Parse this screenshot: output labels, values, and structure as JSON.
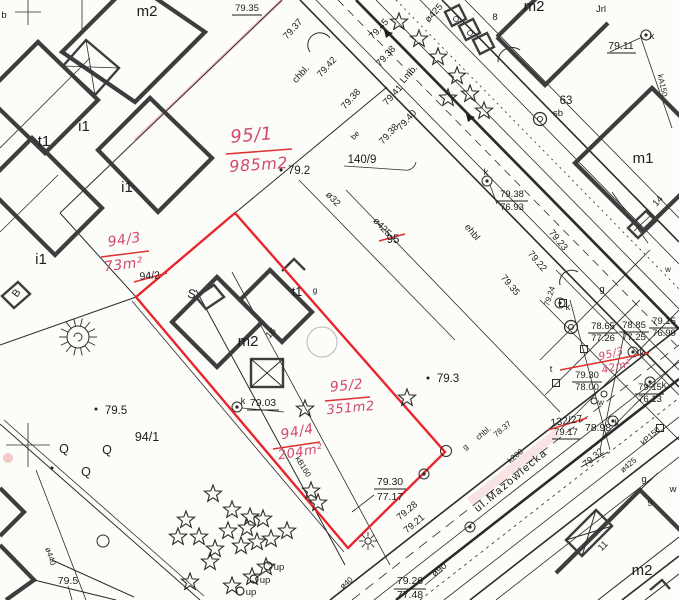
{
  "colors": {
    "paper": "#fcfcf9",
    "line": "#2b2b2b",
    "building": "#3d3d3d",
    "red_boundary": "#e8262d",
    "hand_red": "#d14a72"
  },
  "map": {
    "red_parcel": {
      "points": "235,213 445,452 348,548 136,297"
    },
    "labels": [
      {
        "t": "m2",
        "x": 147,
        "y": 16,
        "r": 0,
        "c": "b14"
      },
      {
        "t": "79.35",
        "x": 247,
        "y": 11,
        "r": 0,
        "c": "b9"
      },
      {
        "t": "b",
        "x": 4,
        "y": 18,
        "r": 0,
        "c": "b9"
      },
      {
        "t": "t1",
        "x": 44,
        "y": 146,
        "r": 0,
        "c": "b14"
      },
      {
        "t": "i1",
        "x": 84,
        "y": 131,
        "r": 0,
        "c": "b14"
      },
      {
        "t": "i1",
        "x": 127,
        "y": 192,
        "r": 0,
        "c": "b14"
      },
      {
        "t": "i1",
        "x": 41,
        "y": 264,
        "r": 0,
        "c": "b14"
      },
      {
        "t": "B",
        "x": 19,
        "y": 295,
        "r": -55,
        "c": "b10"
      },
      {
        "t": "m2",
        "x": 534,
        "y": 11,
        "r": 0,
        "c": "b14"
      },
      {
        "t": "Jrl",
        "x": 601,
        "y": 12,
        "r": 0,
        "c": "b9"
      },
      {
        "t": "79.11",
        "x": 621,
        "y": 49,
        "r": 0,
        "c": "b10"
      },
      {
        "t": "k",
        "x": 652,
        "y": 39,
        "r": 0,
        "c": "b9"
      },
      {
        "t": "kA150",
        "x": 660,
        "y": 86,
        "r": 78,
        "c": "b8"
      },
      {
        "t": "63",
        "x": 566,
        "y": 104,
        "r": 0,
        "c": "b11"
      },
      {
        "t": "sb",
        "x": 558,
        "y": 116,
        "r": 0,
        "c": "b9"
      },
      {
        "t": "m1",
        "x": 643,
        "y": 163,
        "r": 0,
        "c": "b14"
      },
      {
        "t": "14",
        "x": 660,
        "y": 203,
        "r": -48,
        "c": "b9"
      },
      {
        "t": "8",
        "x": 495,
        "y": 20,
        "r": 0,
        "c": "b9"
      },
      {
        "t": "79.2",
        "x": 299,
        "y": 174,
        "r": 0,
        "c": "b11"
      },
      {
        "t": "140/9",
        "x": 362,
        "y": 163,
        "r": 0,
        "c": "b11"
      },
      {
        "t": "95",
        "x": 393,
        "y": 243,
        "r": 0,
        "c": "b11"
      },
      {
        "t": "94/2",
        "x": 150,
        "y": 279,
        "r": -4,
        "c": "b10"
      },
      {
        "t": "94/1",
        "x": 147,
        "y": 441,
        "r": 0,
        "c": "b12"
      },
      {
        "t": "79.5",
        "x": 116,
        "y": 414,
        "r": 0,
        "c": "b11"
      },
      {
        "t": "79.5",
        "x": 68,
        "y": 584,
        "r": 0,
        "c": "b10"
      },
      {
        "t": "79.3",
        "x": 448,
        "y": 382,
        "r": 0,
        "c": "b11"
      },
      {
        "t": "79.38",
        "x": 512,
        "y": 197,
        "r": 0,
        "c": "b9"
      },
      {
        "t": "76.93",
        "x": 512,
        "y": 210,
        "r": 0,
        "c": "b9"
      },
      {
        "t": "k",
        "x": 486,
        "y": 175,
        "r": 0,
        "c": "b9"
      },
      {
        "t": "79.37",
        "x": 295,
        "y": 31,
        "r": -48,
        "c": "b9"
      },
      {
        "t": "chbl.",
        "x": 303,
        "y": 76,
        "r": -48,
        "c": "b9"
      },
      {
        "t": "79.42",
        "x": 329,
        "y": 69,
        "r": -48,
        "c": "b9"
      },
      {
        "t": "79.38",
        "x": 353,
        "y": 101,
        "r": -48,
        "c": "b9"
      },
      {
        "t": "be",
        "x": 357,
        "y": 137,
        "r": -48,
        "c": "b8"
      },
      {
        "t": "79.45",
        "x": 381,
        "y": 31,
        "r": -48,
        "c": "b9"
      },
      {
        "t": "79.38",
        "x": 388,
        "y": 58,
        "r": -48,
        "c": "b9"
      },
      {
        "t": "Lmb.",
        "x": 411,
        "y": 76,
        "r": -48,
        "c": "b9"
      },
      {
        "t": "79.41",
        "x": 395,
        "y": 97,
        "r": -48,
        "c": "b9"
      },
      {
        "t": "79.40",
        "x": 409,
        "y": 122,
        "r": -48,
        "c": "b9"
      },
      {
        "t": "79.38",
        "x": 391,
        "y": 136,
        "r": -48,
        "c": "b9"
      },
      {
        "t": "ø425",
        "x": 436,
        "y": 15,
        "r": -48,
        "c": "b9"
      },
      {
        "t": "ø32",
        "x": 331,
        "y": 201,
        "r": 46,
        "c": "b9"
      },
      {
        "t": "ø425",
        "x": 380,
        "y": 229,
        "r": 46,
        "c": "b9"
      },
      {
        "t": "ehbl",
        "x": 470,
        "y": 234,
        "r": 50,
        "c": "b9"
      },
      {
        "t": "79.23",
        "x": 556,
        "y": 242,
        "r": 50,
        "c": "b9"
      },
      {
        "t": "79.22",
        "x": 535,
        "y": 263,
        "r": 50,
        "c": "b9"
      },
      {
        "t": "79.35",
        "x": 508,
        "y": 287,
        "r": 50,
        "c": "b9"
      },
      {
        "t": "g",
        "x": 602,
        "y": 292,
        "r": 0,
        "c": "b9"
      },
      {
        "t": "79.24",
        "x": 552,
        "y": 297,
        "r": -72,
        "c": "b8"
      },
      {
        "t": "78.65",
        "x": 603,
        "y": 329,
        "r": 0,
        "c": "b9"
      },
      {
        "t": "77.26",
        "x": 603,
        "y": 341,
        "r": 0,
        "c": "b9"
      },
      {
        "t": "78.85",
        "x": 634,
        "y": 328,
        "r": 0,
        "c": "b9"
      },
      {
        "t": "77.25",
        "x": 634,
        "y": 340,
        "r": 0,
        "c": "b9"
      },
      {
        "t": "79.15",
        "x": 664,
        "y": 324,
        "r": 0,
        "c": "b9"
      },
      {
        "t": "76.99",
        "x": 664,
        "y": 336,
        "r": 0,
        "c": "b9"
      },
      {
        "t": "79.30",
        "x": 587,
        "y": 378,
        "r": 0,
        "c": "b9"
      },
      {
        "t": "78.00",
        "x": 587,
        "y": 390,
        "r": 0,
        "c": "b9"
      },
      {
        "t": "79.15",
        "x": 650,
        "y": 390,
        "r": 0,
        "c": "b9"
      },
      {
        "t": "76.13",
        "x": 650,
        "y": 402,
        "r": 0,
        "c": "b9"
      },
      {
        "t": "132/27",
        "x": 567,
        "y": 424,
        "r": -8,
        "c": "b10"
      },
      {
        "t": "79.17",
        "x": 566,
        "y": 435,
        "r": 0,
        "c": "b9"
      },
      {
        "t": "78.98",
        "x": 598,
        "y": 431,
        "r": 0,
        "c": "b10"
      },
      {
        "t": "k",
        "x": 617,
        "y": 426,
        "r": 0,
        "c": "b9"
      },
      {
        "t": "kP150",
        "x": 652,
        "y": 438,
        "r": -42,
        "c": "b8"
      },
      {
        "t": "79.32",
        "x": 595,
        "y": 460,
        "r": -40,
        "c": "b9"
      },
      {
        "t": "ø425",
        "x": 630,
        "y": 467,
        "r": -40,
        "c": "b8"
      },
      {
        "t": "g",
        "x": 644,
        "y": 482,
        "r": 0,
        "c": "b9"
      },
      {
        "t": "w",
        "x": 673,
        "y": 492,
        "r": 0,
        "c": "b9"
      },
      {
        "t": "w",
        "x": 601,
        "y": 405,
        "r": 0,
        "c": "b8"
      },
      {
        "t": "w",
        "x": 668,
        "y": 272,
        "r": 0,
        "c": "b8"
      },
      {
        "t": "t",
        "x": 551,
        "y": 372,
        "r": 0,
        "c": "b9"
      },
      {
        "t": "k",
        "x": 568,
        "y": 310,
        "r": 0,
        "c": "b9"
      },
      {
        "t": "k",
        "x": 642,
        "y": 356,
        "r": 0,
        "c": "b9"
      },
      {
        "t": "k",
        "x": 664,
        "y": 388,
        "r": 0,
        "c": "b9"
      },
      {
        "t": "ul.Mazowiecka",
        "x": 513,
        "y": 483,
        "r": -40,
        "c": "b10s"
      },
      {
        "t": "k200",
        "x": 517,
        "y": 458,
        "r": -40,
        "c": "b8"
      },
      {
        "t": "chbl.",
        "x": 485,
        "y": 435,
        "r": -40,
        "c": "b8"
      },
      {
        "t": "78.37",
        "x": 504,
        "y": 431,
        "r": -40,
        "c": "b8"
      },
      {
        "t": "g",
        "x": 467,
        "y": 449,
        "r": -40,
        "c": "b8"
      },
      {
        "t": "79.28",
        "x": 409,
        "y": 513,
        "r": -40,
        "c": "b9"
      },
      {
        "t": "79.21",
        "x": 416,
        "y": 526,
        "r": -40,
        "c": "b9"
      },
      {
        "t": "ø90",
        "x": 441,
        "y": 572,
        "r": -40,
        "c": "b9"
      },
      {
        "t": "ø40",
        "x": 348,
        "y": 585,
        "r": -40,
        "c": "b8"
      },
      {
        "t": "79.26",
        "x": 410,
        "y": 584,
        "r": 0,
        "c": "b10"
      },
      {
        "t": "77.48",
        "x": 410,
        "y": 598,
        "r": 0,
        "c": "b10"
      },
      {
        "t": "79.30",
        "x": 390,
        "y": 485,
        "r": 0,
        "c": "b10"
      },
      {
        "t": "77.17",
        "x": 390,
        "y": 500,
        "r": 0,
        "c": "b10"
      },
      {
        "t": "79.03",
        "x": 263,
        "y": 406,
        "r": 0,
        "c": "b10"
      },
      {
        "t": "k",
        "x": 243,
        "y": 404,
        "r": 0,
        "c": "b9"
      },
      {
        "t": "up",
        "x": 279,
        "y": 570,
        "r": 0,
        "c": "b9"
      },
      {
        "t": "up",
        "x": 265,
        "y": 583,
        "r": 0,
        "c": "b9"
      },
      {
        "t": "up",
        "x": 251,
        "y": 595,
        "r": 0,
        "c": "b9"
      },
      {
        "t": "9",
        "x": 650,
        "y": 506,
        "r": 0,
        "c": "b9"
      },
      {
        "t": "11",
        "x": 605,
        "y": 548,
        "r": -45,
        "c": "b9"
      },
      {
        "t": "m2",
        "x": 642,
        "y": 575,
        "r": 0,
        "c": "b14"
      },
      {
        "t": "t1",
        "x": 297,
        "y": 296,
        "r": 0,
        "c": "b12"
      },
      {
        "t": "g",
        "x": 315,
        "y": 293,
        "r": 0,
        "c": "b8"
      },
      {
        "t": "16",
        "x": 273,
        "y": 335,
        "r": -48,
        "c": "b9"
      },
      {
        "t": "m2",
        "x": 248,
        "y": 346,
        "r": 0,
        "c": "b14"
      },
      {
        "t": "S",
        "x": 191,
        "y": 298,
        "r": 10,
        "c": "b12"
      },
      {
        "t": "ø440",
        "x": 48,
        "y": 557,
        "r": 72,
        "c": "b8"
      },
      {
        "t": "kB160",
        "x": 301,
        "y": 468,
        "r": 58,
        "c": "b8"
      },
      {
        "t": "Q",
        "x": 64,
        "y": 453,
        "r": 0,
        "c": "b12"
      },
      {
        "t": "Q",
        "x": 107,
        "y": 454,
        "r": 0,
        "c": "b12"
      },
      {
        "t": "Q",
        "x": 86,
        "y": 476,
        "r": 0,
        "c": "b12"
      },
      {
        "t": "95/1",
        "x": 252,
        "y": 141,
        "r": -5,
        "c": "h16"
      },
      {
        "t": "985m2",
        "x": 259,
        "y": 170,
        "r": -4,
        "c": "h15"
      },
      {
        "t": "94/3",
        "x": 125,
        "y": 244,
        "r": -9,
        "c": "h13"
      },
      {
        "t": "73m²",
        "x": 124,
        "y": 269,
        "r": -7,
        "c": "h13"
      },
      {
        "t": "95/2",
        "x": 347,
        "y": 390,
        "r": -6,
        "c": "h13"
      },
      {
        "t": "351m2",
        "x": 351,
        "y": 412,
        "r": -5,
        "c": "h12"
      },
      {
        "t": "94/4",
        "x": 298,
        "y": 436,
        "r": -11,
        "c": "h13"
      },
      {
        "t": "204m²",
        "x": 301,
        "y": 456,
        "r": -9,
        "c": "h12"
      },
      {
        "t": "95/3",
        "x": 612,
        "y": 357,
        "r": -14,
        "c": "h10"
      },
      {
        "t": "42m²",
        "x": 617,
        "y": 370,
        "r": -14,
        "c": "h10"
      }
    ],
    "marks": [
      {
        "x1": 232,
        "y1": 15,
        "x2": 262,
        "y2": 15,
        "c": "k"
      },
      {
        "x1": 607,
        "y1": 53,
        "x2": 636,
        "y2": 53,
        "c": "k"
      },
      {
        "x1": 497,
        "y1": 201,
        "x2": 528,
        "y2": 201,
        "c": "k"
      },
      {
        "x1": 588,
        "y1": 333,
        "x2": 618,
        "y2": 333,
        "c": "k"
      },
      {
        "x1": 619,
        "y1": 332,
        "x2": 649,
        "y2": 332,
        "c": "k"
      },
      {
        "x1": 649,
        "y1": 328,
        "x2": 678,
        "y2": 328,
        "c": "k"
      },
      {
        "x1": 572,
        "y1": 382,
        "x2": 602,
        "y2": 382,
        "c": "k"
      },
      {
        "x1": 635,
        "y1": 394,
        "x2": 664,
        "y2": 394,
        "c": "k"
      },
      {
        "x1": 394,
        "y1": 589,
        "x2": 426,
        "y2": 589,
        "c": "k"
      },
      {
        "x1": 374,
        "y1": 489,
        "x2": 406,
        "y2": 489,
        "c": "k"
      },
      {
        "x1": 552,
        "y1": 439,
        "x2": 580,
        "y2": 439,
        "c": "k"
      },
      {
        "x1": 247,
        "y1": 410,
        "x2": 279,
        "y2": 410,
        "c": "k"
      },
      {
        "x1": 581,
        "y1": 467,
        "x2": 608,
        "y2": 452,
        "c": "k"
      },
      {
        "x1": 226,
        "y1": 154,
        "x2": 292,
        "y2": 149,
        "c": "r"
      },
      {
        "x1": 101,
        "y1": 257,
        "x2": 149,
        "y2": 251,
        "c": "r"
      },
      {
        "x1": 325,
        "y1": 401,
        "x2": 370,
        "y2": 397,
        "c": "r"
      },
      {
        "x1": 273,
        "y1": 449,
        "x2": 320,
        "y2": 442,
        "c": "r"
      },
      {
        "x1": 560,
        "y1": 370,
        "x2": 649,
        "y2": 353,
        "c": "r"
      },
      {
        "x1": 379,
        "y1": 241,
        "x2": 405,
        "y2": 234,
        "c": "r"
      },
      {
        "x1": 134,
        "y1": 282,
        "x2": 167,
        "y2": 273,
        "c": "r"
      },
      {
        "x1": 548,
        "y1": 430,
        "x2": 587,
        "y2": 418,
        "c": "r"
      }
    ],
    "symbols": {
      "poles": [
        [
          237,
          407
        ],
        [
          487,
          181
        ],
        [
          560,
          303
        ],
        [
          633,
          352
        ],
        [
          650,
          382
        ],
        [
          613,
          421
        ],
        [
          646,
          35
        ],
        [
          424,
          474
        ],
        [
          470,
          527
        ]
      ],
      "double_circles": [
        [
          540,
          119
        ],
        [
          571,
          327
        ]
      ],
      "squares": [
        [
          556,
          383
        ],
        [
          584,
          349
        ],
        [
          563,
          303
        ],
        [
          660,
          428
        ]
      ],
      "small_circles": [
        [
          594,
          401
        ],
        [
          604,
          394
        ]
      ],
      "lamp": [
        368,
        541
      ],
      "bush": [
        78,
        337
      ],
      "oup_circles": [
        [
          268,
          566
        ],
        [
          254,
          579
        ],
        [
          240,
          591
        ]
      ],
      "dots": [
        [
          281,
          170
        ],
        [
          96,
          409
        ],
        [
          428,
          378
        ],
        [
          52,
          468
        ]
      ],
      "crosses": [
        [
          28,
          445,
          22
        ],
        [
          28,
          12,
          13
        ]
      ],
      "stars": [
        [
          399,
          22
        ],
        [
          419,
          39
        ],
        [
          438,
          57
        ],
        [
          457,
          76
        ],
        [
          470,
          94
        ],
        [
          484,
          111
        ],
        [
          448,
          98
        ],
        [
          305,
          409
        ],
        [
          407,
          398
        ],
        [
          311,
          491
        ],
        [
          318,
          503
        ],
        [
          213,
          494
        ],
        [
          232,
          510
        ],
        [
          250,
          517
        ],
        [
          263,
          519
        ],
        [
          247,
          528
        ],
        [
          228,
          531
        ],
        [
          199,
          537
        ],
        [
          186,
          520
        ],
        [
          178,
          537
        ],
        [
          215,
          549
        ],
        [
          241,
          546
        ],
        [
          257,
          542
        ],
        [
          271,
          539
        ],
        [
          287,
          531
        ],
        [
          210,
          562
        ],
        [
          190,
          582
        ],
        [
          232,
          586
        ],
        [
          252,
          577
        ],
        [
          266,
          567
        ]
      ]
    }
  }
}
